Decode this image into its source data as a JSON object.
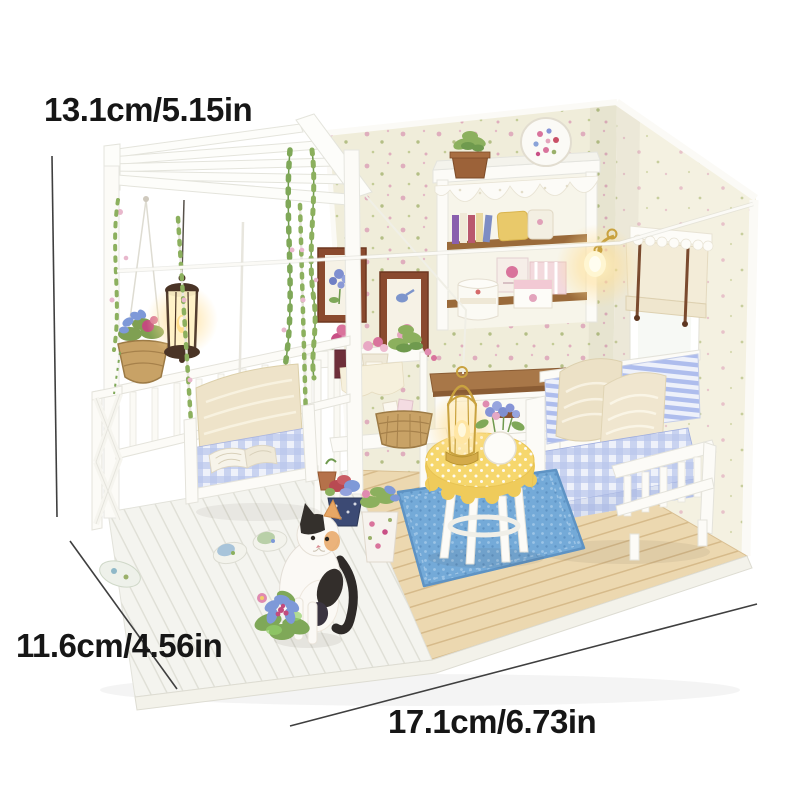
{
  "page": {
    "background": "#ffffff",
    "description": "Product photo of a DIY miniature dollhouse room kit (porch with pergola and swing, living room with hutch, sofa, table and cat figurine) annotated with three size dimension lines"
  },
  "annotations": {
    "height": "13.1cm/5.15in",
    "depth": "11.6cm/4.56in",
    "width": "17.1cm/6.73in"
  },
  "palette": {
    "background": "#ffffff",
    "label_text": "#161616",
    "dimension_line": "#3f3f3f",
    "wallpaper_back": "#f0edda",
    "wallpaper_right": "#f4f1e1",
    "wood_trim": "#9a6a3a",
    "cabinet_wood_top": "#a87748",
    "floor_wood": "#ecd8b0",
    "deck_white": "#f4f4ef",
    "furniture_white": "#fcfbf7",
    "gingham_blue": "#b9c6ec",
    "rug_blue": "#74aad8",
    "tablecloth_yellow": "#f6d76d",
    "warm_glow": "#ffe09a",
    "leaf_green": "#7fa858",
    "flower_pink": "#e08bb0",
    "flower_magenta": "#c24b7e",
    "flower_blue": "#8694d6",
    "basket_tan": "#c8a266",
    "lantern_metal": "#4a3426",
    "lamp_gold": "#c9a23f",
    "cat_black": "#34302c",
    "cat_white": "#fbf9f5",
    "cat_orange": "#e8a765"
  }
}
